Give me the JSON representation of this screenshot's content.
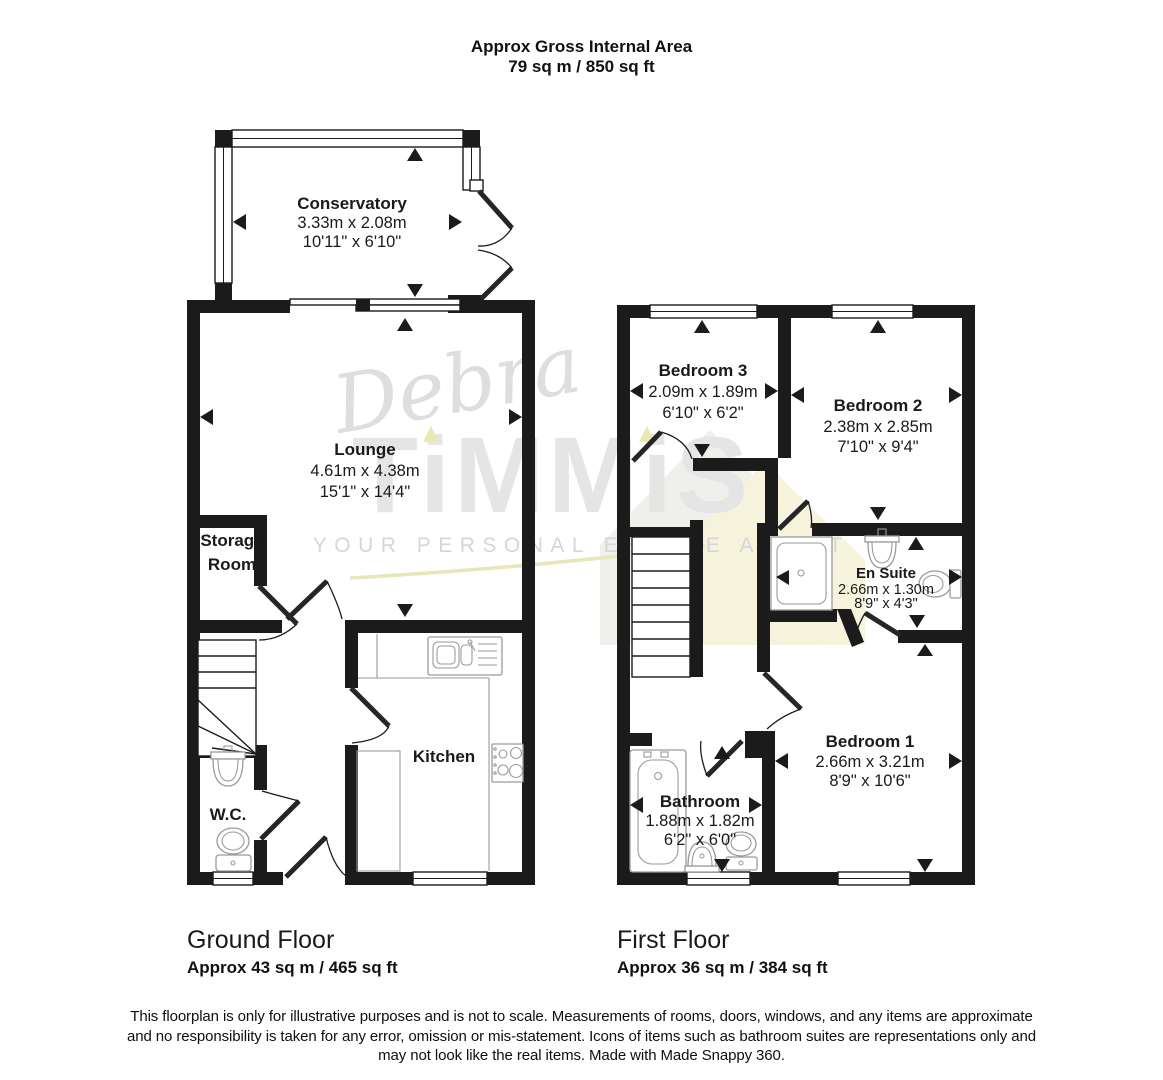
{
  "header": {
    "line1": "Approx Gross Internal Area",
    "line2": "79 sq m / 850 sq ft"
  },
  "watermark": {
    "script": "Debra",
    "brand": "TiMMiS",
    "tagline": "YOUR PERSONAL ESTATE AGENT"
  },
  "ground_floor": {
    "caption": "Ground Floor",
    "area": "Approx 43 sq m / 465 sq ft",
    "rooms": {
      "conservatory": {
        "name": "Conservatory",
        "metric": "3.33m x 2.08m",
        "imperial": "10'11\" x 6'10\""
      },
      "lounge": {
        "name": "Lounge",
        "metric": "4.61m x 4.38m",
        "imperial": "15'1\" x 14'4\""
      },
      "storage": {
        "line1": "Storage",
        "line2": "Room"
      },
      "kitchen": {
        "name": "Kitchen"
      },
      "wc": {
        "name": "W.C."
      }
    }
  },
  "first_floor": {
    "caption": "First Floor",
    "area": "Approx 36 sq m / 384 sq ft",
    "rooms": {
      "bedroom3": {
        "name": "Bedroom 3",
        "metric": "2.09m x 1.89m",
        "imperial": "6'10\" x 6'2\""
      },
      "bedroom2": {
        "name": "Bedroom 2",
        "metric": "2.38m x 2.85m",
        "imperial": "7'10\" x 9'4\""
      },
      "ensuite": {
        "name": "En Suite",
        "metric": "2.66m x 1.30m",
        "imperial": "8'9\" x 4'3\""
      },
      "bedroom1": {
        "name": "Bedroom 1",
        "metric": "2.66m x 3.21m",
        "imperial": "8'9\" x 10'6\""
      },
      "bathroom": {
        "name": "Bathroom",
        "metric": "1.88m x 1.82m",
        "imperial": "6'2\" x 6'0\""
      }
    }
  },
  "disclaimer": {
    "line1": "This floorplan is only for illustrative purposes and is not to scale. Measurements of rooms, doors, windows, and any items are approximate",
    "line2": "and no responsibility is taken for any error, omission or mis-statement. Icons of items such as bathroom suites are representations only and",
    "line3": "may not look like the real items. Made with Made Snappy 360."
  },
  "colors": {
    "wall": "#1b1b1b",
    "fixture_outline": "#9a9a9a",
    "watermark_gray": "#e5e5e5",
    "watermark_yellow": "#ebe8b4"
  }
}
